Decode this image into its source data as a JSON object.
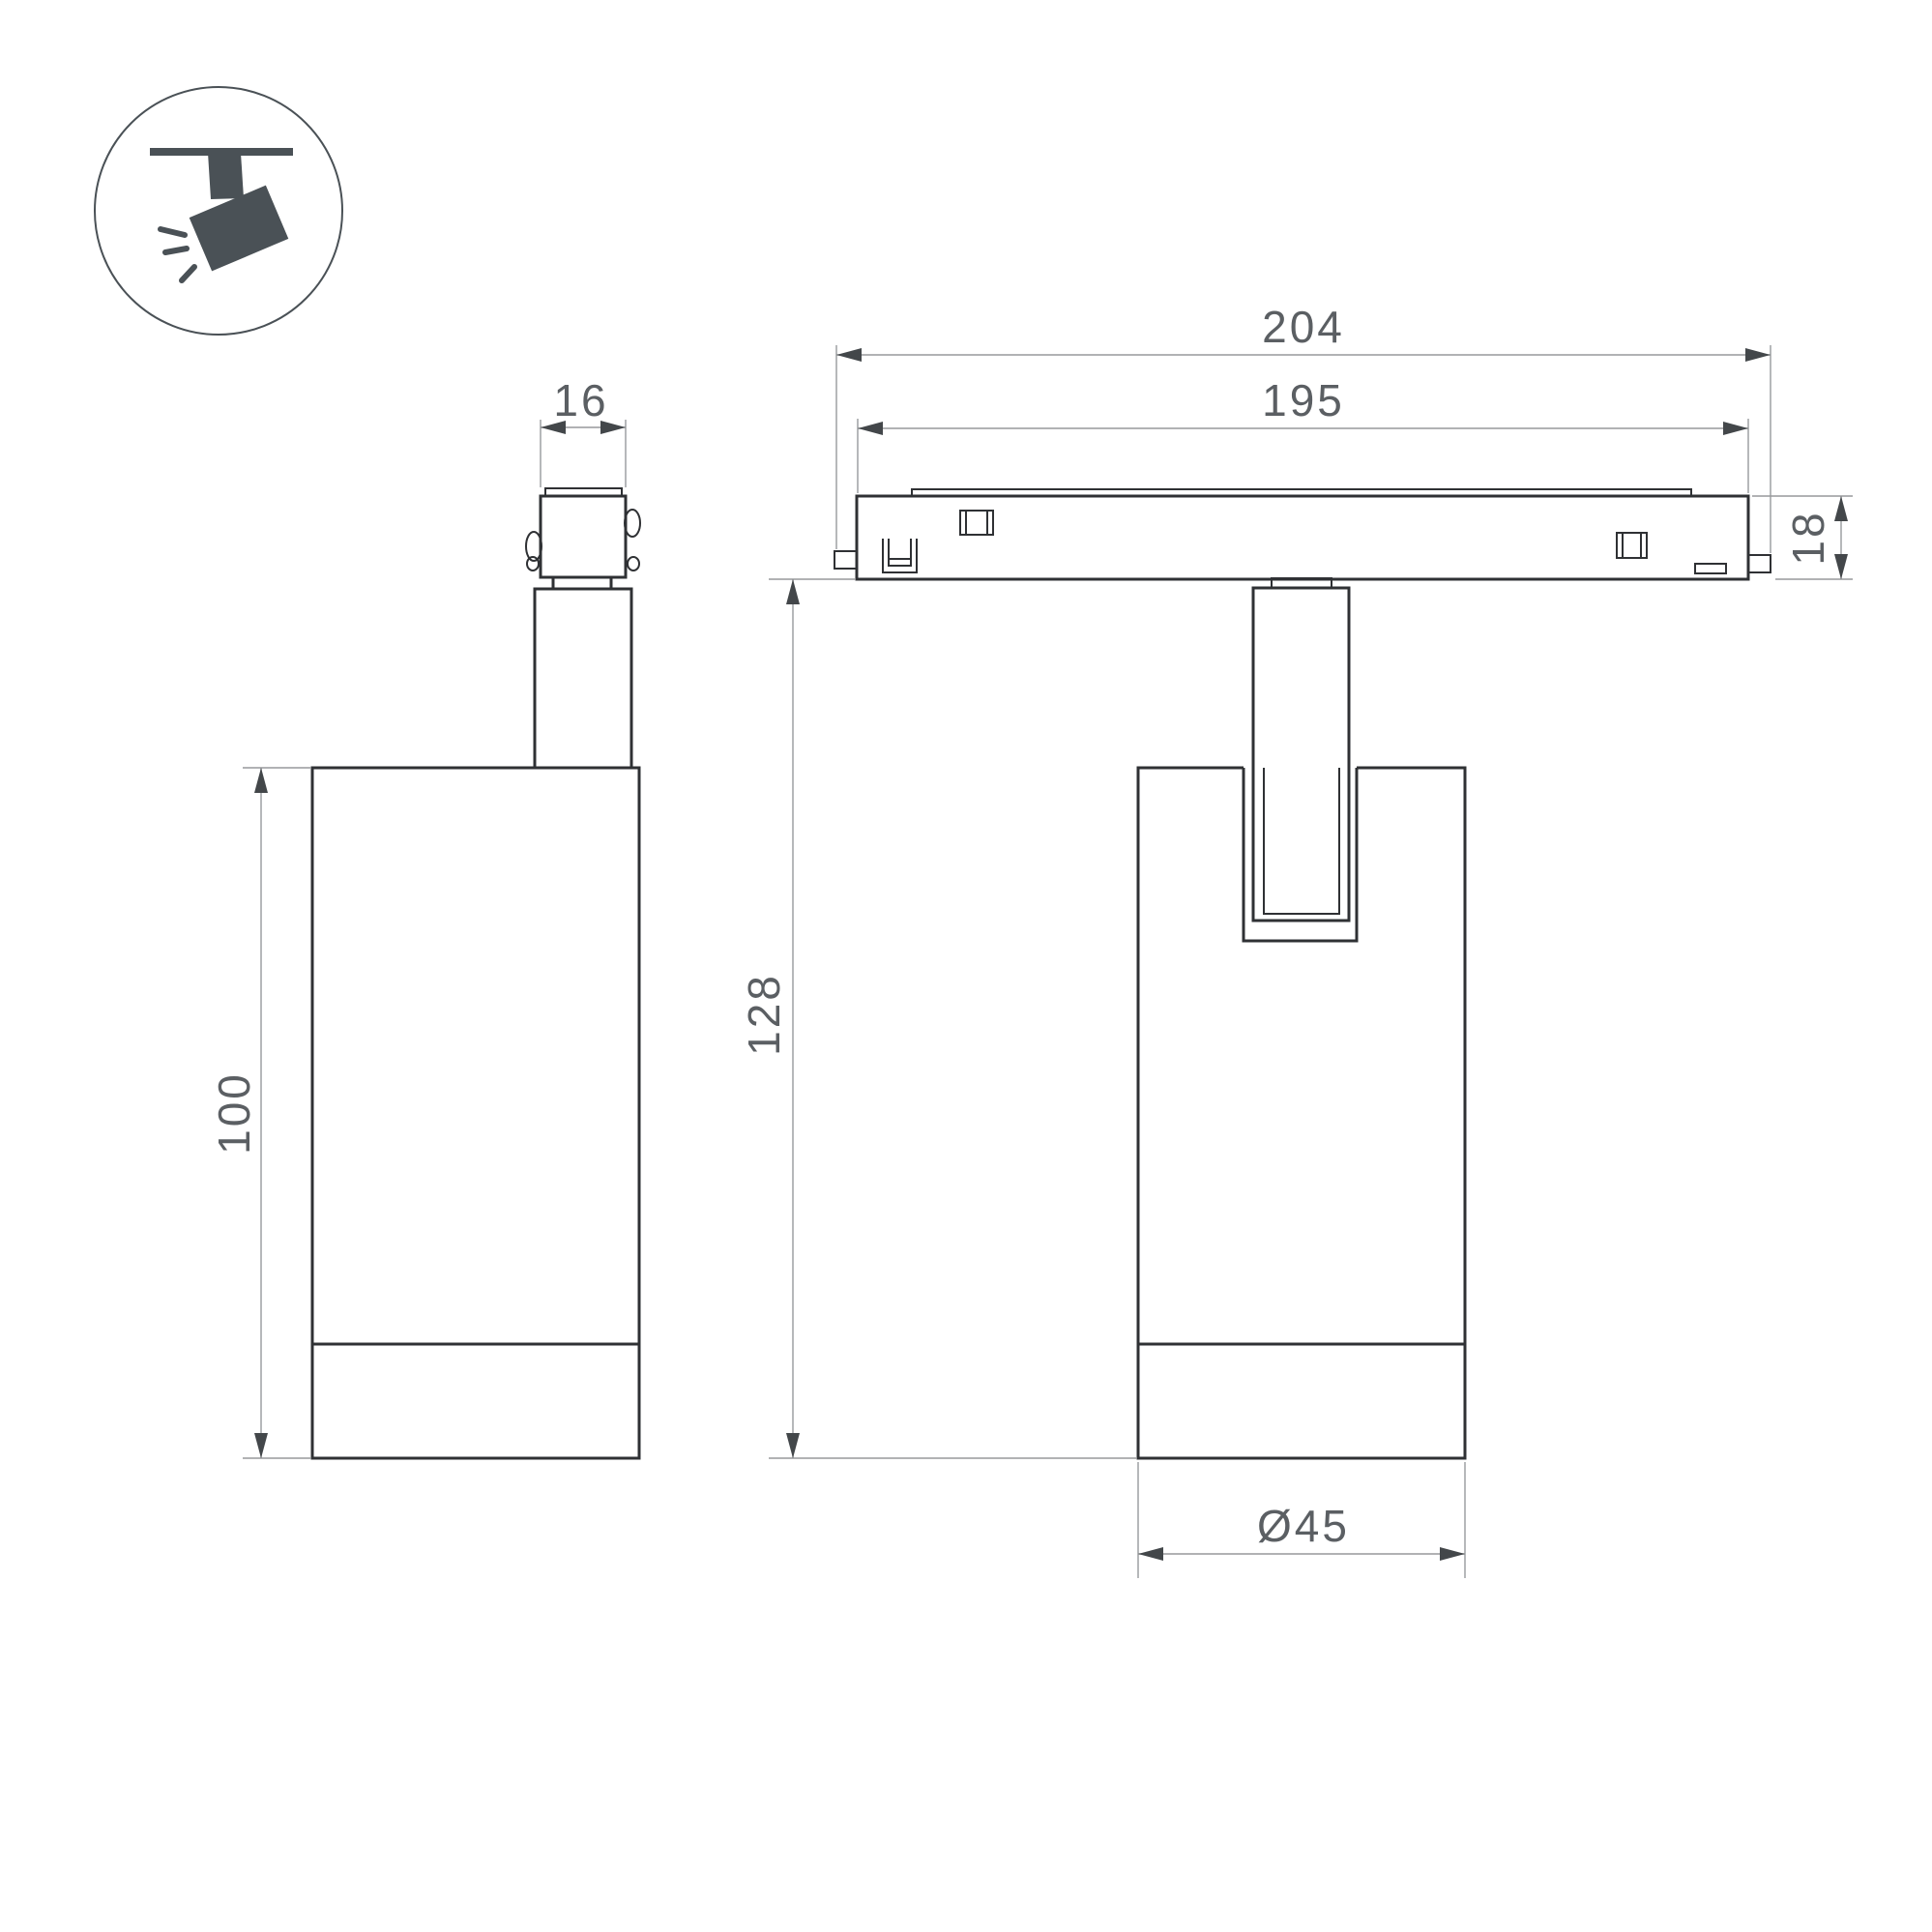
{
  "drawing": {
    "type": "luminaire dimension drawing",
    "icon": {
      "name": "track-spotlight-icon",
      "description": "spotlight hanging from ceiling track"
    },
    "views": {
      "side_view": {
        "dims": {
          "adapter_width": "16",
          "body_height": "100"
        }
      },
      "front_view": {
        "dims": {
          "track_overall": "204",
          "track_inner": "195",
          "track_height": "18",
          "total_height": "128",
          "body_diameter": "Ø45"
        }
      }
    },
    "colors": {
      "outline": "#2f3134",
      "dimension_line": "#97999c",
      "dimension_text": "#5b5f63",
      "arrowhead": "#43474a",
      "icon": "#4a5156",
      "background": "#ffffff"
    }
  }
}
